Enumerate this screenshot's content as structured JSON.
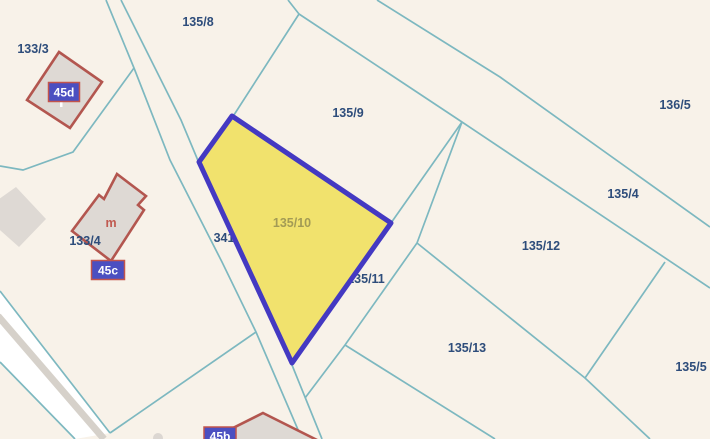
{
  "map": {
    "background": "#f8f2e9",
    "line_color": "#7db8c0",
    "label_color": "#2e4d7b",
    "building_fill": "#ded9d4",
    "building_stroke": "#b3564f",
    "marker_fill": "#4b4fc1",
    "marker_border": "#c2544c",
    "highlight": {
      "parcel_label": "135/10",
      "label_color": "#a39b55",
      "fill": "#f1e26d",
      "stroke": "#4439c2",
      "points": [
        [
          232,
          116
        ],
        [
          391,
          223
        ],
        [
          292,
          363
        ],
        [
          199,
          162
        ]
      ],
      "label_x": 292,
      "label_y": 227
    },
    "sw_road": {
      "white_fill": "#ffffff",
      "gray_stripe_color": "#d6d1ca",
      "white_band": [
        [
          0,
          291
        ],
        [
          30,
          330
        ],
        [
          110,
          433
        ],
        [
          75,
          439
        ],
        [
          0,
          362
        ]
      ],
      "gray_stripe": [
        [
          -2,
          316
        ],
        [
          104,
          439
        ]
      ]
    },
    "boundary_lines": [
      {
        "name": "road-west-edge",
        "points": [
          [
            106,
            0
          ],
          [
            134,
            68
          ],
          [
            170,
            160
          ],
          [
            222,
            262
          ],
          [
            256,
            332
          ],
          [
            302,
            439
          ]
        ]
      },
      {
        "name": "road-east-edge",
        "points": [
          [
            121,
            0
          ],
          [
            181,
            120
          ],
          [
            199,
            163
          ],
          [
            292,
            365
          ],
          [
            322,
            439
          ]
        ]
      },
      {
        "name": "branch-west",
        "points": [
          [
            134,
            68
          ],
          [
            73,
            152
          ],
          [
            23,
            170
          ],
          [
            0,
            166
          ]
        ]
      },
      {
        "name": "parcel-8-9-boundary",
        "points": [
          [
            288,
            0
          ],
          [
            299,
            14
          ],
          [
            232,
            118
          ]
        ]
      },
      {
        "name": "diagonal-upper",
        "points": [
          [
            377,
            0
          ],
          [
            500,
            77
          ],
          [
            710,
            227
          ]
        ]
      },
      {
        "name": "diagonal-lower",
        "points": [
          [
            299,
            14
          ],
          [
            462,
            122
          ],
          [
            710,
            288
          ]
        ]
      },
      {
        "name": "wedge-line-1",
        "points": [
          [
            462,
            122
          ],
          [
            391,
            223
          ]
        ]
      },
      {
        "name": "wedge-line-2",
        "points": [
          [
            462,
            122
          ],
          [
            417,
            243
          ],
          [
            345,
            345
          ],
          [
            305,
            398
          ]
        ]
      },
      {
        "name": "parcel-12-13-boundary",
        "points": [
          [
            417,
            243
          ],
          [
            585,
            378
          ],
          [
            650,
            439
          ]
        ]
      },
      {
        "name": "parcel-12-5-boundary",
        "points": [
          [
            665,
            262
          ],
          [
            585,
            378
          ]
        ]
      },
      {
        "name": "parcel-13-south-boundary",
        "points": [
          [
            345,
            345
          ],
          [
            495,
            439
          ]
        ]
      },
      {
        "name": "sw-road-edge-north",
        "points": [
          [
            0,
            291
          ],
          [
            30,
            330
          ],
          [
            110,
            433
          ]
        ]
      },
      {
        "name": "sw-road-to-main-road",
        "points": [
          [
            110,
            433
          ],
          [
            256,
            332
          ]
        ]
      },
      {
        "name": "sw-road-edge-south",
        "points": [
          [
            0,
            362
          ],
          [
            75,
            439
          ]
        ]
      }
    ],
    "parcel_labels": [
      {
        "text": "133/3",
        "x": 33,
        "y": 53
      },
      {
        "text": "135/8",
        "x": 198,
        "y": 26
      },
      {
        "text": "135/9",
        "x": 348,
        "y": 117
      },
      {
        "text": "136/5",
        "x": 675,
        "y": 109
      },
      {
        "text": "135/4",
        "x": 623,
        "y": 198
      },
      {
        "text": "135/12",
        "x": 541,
        "y": 250
      },
      {
        "text": "341",
        "x": 224,
        "y": 242
      },
      {
        "text": "135/11",
        "x": 366,
        "y": 283
      },
      {
        "text": "135/13",
        "x": 467,
        "y": 352
      },
      {
        "text": "135/5",
        "x": 691,
        "y": 371
      },
      {
        "text": "133/4",
        "x": 85,
        "y": 245
      }
    ],
    "building_letter": {
      "text": "m",
      "x": 111,
      "y": 227,
      "color": "#c05a50"
    },
    "buildings": [
      {
        "name": "building-45d",
        "outlined": true,
        "points": [
          [
            59,
            52
          ],
          [
            102,
            82
          ],
          [
            70,
            128
          ],
          [
            27,
            100
          ]
        ]
      },
      {
        "name": "building-m",
        "outlined": true,
        "points": [
          [
            117,
            174
          ],
          [
            146,
            196
          ],
          [
            138,
            205
          ],
          [
            144,
            210
          ],
          [
            111,
            261
          ],
          [
            72,
            231
          ],
          [
            99,
            195
          ],
          [
            104,
            199
          ]
        ]
      },
      {
        "name": "building-45b",
        "outlined": true,
        "points": [
          [
            263,
            413
          ],
          [
            319,
            441
          ],
          [
            207,
            441
          ]
        ]
      },
      {
        "name": "building-gray",
        "outlined": false,
        "points": [
          [
            -8,
            204
          ],
          [
            16,
            187
          ],
          [
            46,
            219
          ],
          [
            19,
            247
          ],
          [
            -8,
            223
          ]
        ]
      }
    ],
    "small_circle": {
      "cx": 158,
      "cy": 438,
      "r": 5,
      "color": "#dcd7d2"
    },
    "address_markers": [
      {
        "text": "45d",
        "x": 64,
        "y": 92,
        "w": 31,
        "h": 19,
        "pin": true
      },
      {
        "text": "45c",
        "x": 108,
        "y": 270,
        "w": 33,
        "h": 19,
        "pin": false
      },
      {
        "text": "45b",
        "x": 220,
        "y": 436,
        "w": 32,
        "h": 18,
        "pin": false
      }
    ]
  }
}
